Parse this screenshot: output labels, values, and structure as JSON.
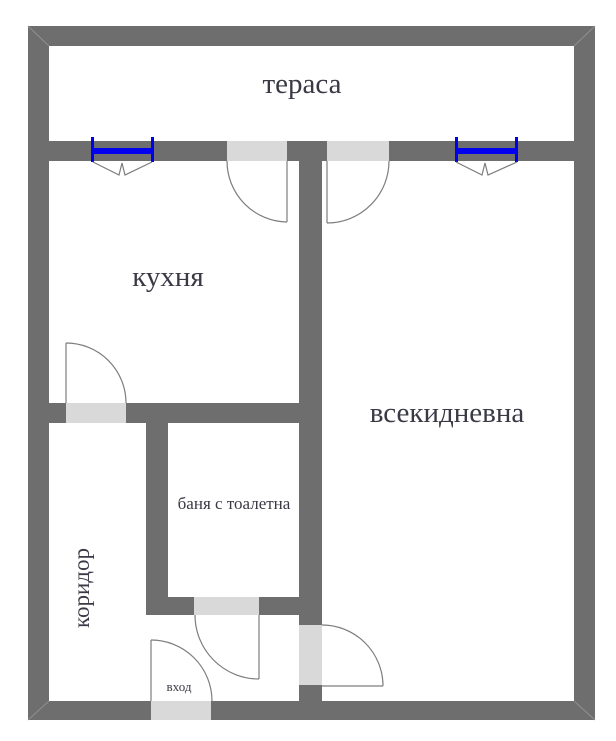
{
  "document": {
    "type": "apartment-floor-plan",
    "language": "Bulgarian"
  },
  "rooms": {
    "terrace": {
      "label": "тераса"
    },
    "kitchen": {
      "label": "кухня"
    },
    "living": {
      "label": "всекидневна"
    },
    "bathroom": {
      "label": "баня с тоалетна"
    },
    "corridor": {
      "label": "коридор"
    },
    "entrance": {
      "label": "вход"
    }
  },
  "features": {
    "windows": [
      "kitchen-terrace-window",
      "living-terrace-window"
    ],
    "doors": [
      "kitchen-to-terrace-door",
      "living-to-terrace-door",
      "corridor-to-kitchen-door",
      "bathroom-door",
      "corridor-to-living-door",
      "entrance-door"
    ]
  },
  "colors": {
    "wall": "#6e6e6e",
    "door_threshold": "#d9d9d9",
    "window_glass": "#0000ee",
    "door_swing_line": "#7d7d7d",
    "label_text": "#3a3a46",
    "background": "#ffffff"
  }
}
